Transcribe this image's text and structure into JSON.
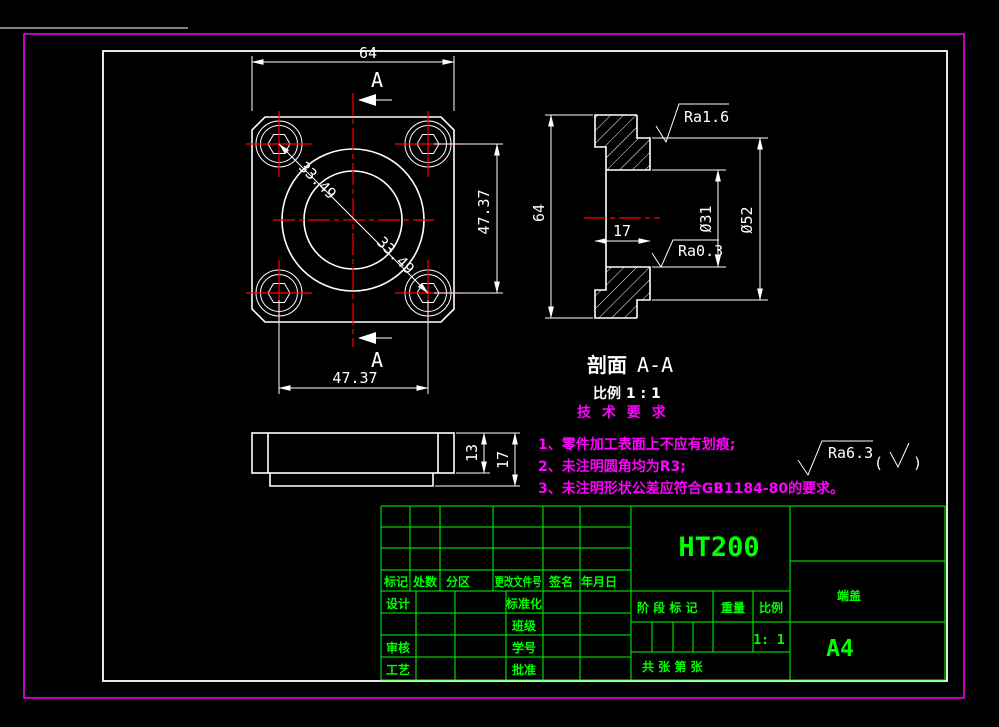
{
  "colors": {
    "background": "#000000",
    "outer_border": "#ff00ff",
    "drawing_frame": "#ffffff",
    "geometry": "#ffffff",
    "centerline": "#ff0000",
    "title_block": "#00ff00",
    "tech_requirements": "#ff00ff"
  },
  "front_view": {
    "dim_top": "64",
    "dim_right": "47.37",
    "dim_bottom": "47.37",
    "dim_diag_upper": "33.49",
    "dim_diag_lower": "33.49",
    "section_letter_top": "A",
    "section_letter_bottom": "A"
  },
  "side_view": {
    "dim_plate": "13",
    "dim_total": "17"
  },
  "section_view": {
    "dim_height": "64",
    "dim_depth": "17",
    "dim_bore": "Ø31",
    "dim_boss": "Ø52",
    "ra_top": "Ra1.6",
    "ra_bore": "Ra0.3",
    "title": "剖面",
    "title_suffix": "A-A",
    "scale_note": "比例  1 : 1"
  },
  "tech": {
    "heading": "技 术 要 求",
    "items": [
      "1、零件加工表面上不应有划痕;",
      "2、未注明圆角均为R3;",
      "3、未注明形状公差应符合GB1184-80的要求。"
    ],
    "ra_general": "Ra6.3",
    "paren_open": "(",
    "paren_close": ")"
  },
  "title_block": {
    "material": "HT200",
    "part_name": "端盖",
    "sheet": "A4",
    "scale_value": "1: 1",
    "stage_label": "阶 段 标 记",
    "weight_label": "重量",
    "scale_label": "比例",
    "sheets_label": "共    张  第    张",
    "col_mark": "标记",
    "col_count": "处数",
    "col_zone": "分区",
    "col_doc": "更改文件号",
    "col_sign": "签名",
    "col_date": "年月日",
    "row_design": "设计",
    "row_standard": "标准化",
    "row_class": "班级",
    "row_check": "审核",
    "row_number": "学号",
    "row_process": "工艺",
    "row_approve": "批准"
  }
}
